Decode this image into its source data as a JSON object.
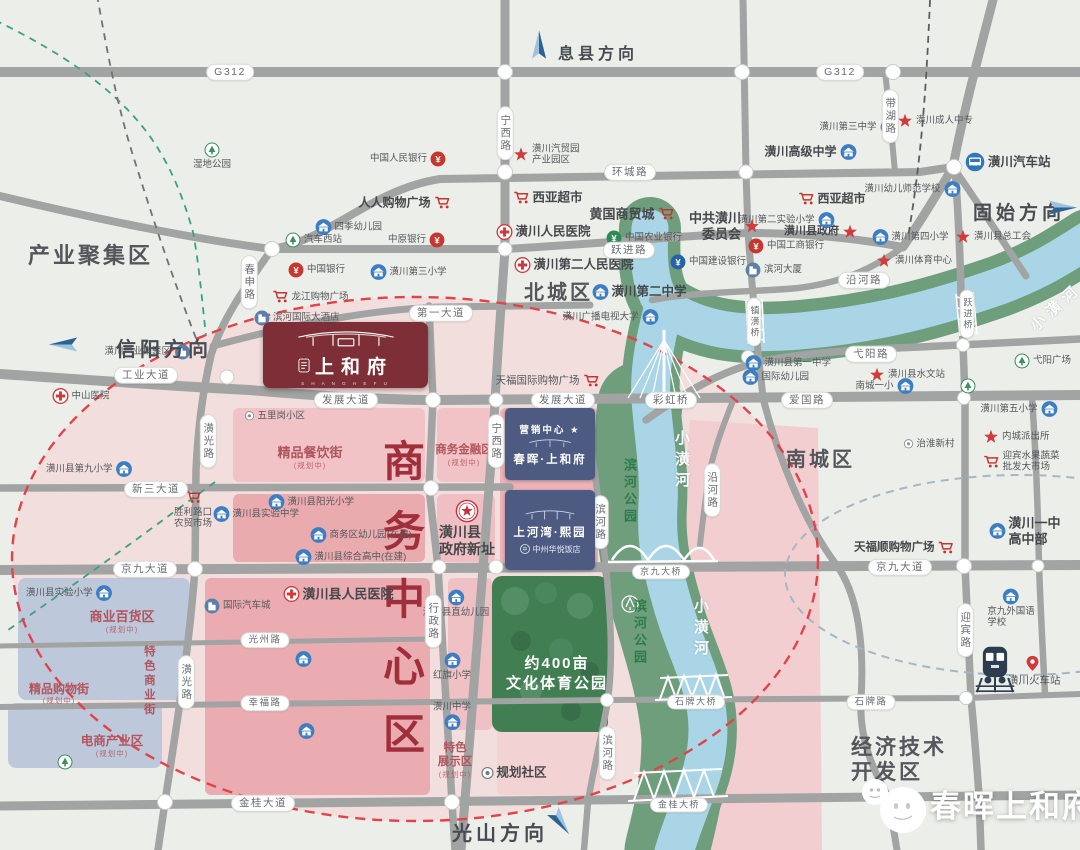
{
  "regions": [
    {
      "t": "产业聚集区",
      "x": 28,
      "y": 243,
      "s": 22
    },
    {
      "t": "北城区",
      "x": 524,
      "y": 282,
      "s": 20
    },
    {
      "t": "南城区",
      "x": 786,
      "y": 449,
      "s": 20
    },
    {
      "t": "经济技术",
      "x": 851,
      "y": 736,
      "s": 21
    },
    {
      "t": "开发区",
      "x": 851,
      "y": 761,
      "s": 21
    }
  ],
  "biz": {
    "chars": [
      "商",
      "务",
      "中",
      "心",
      "区"
    ],
    "x": 404,
    "ys": [
      462,
      532,
      600,
      667,
      735
    ]
  },
  "directions": [
    {
      "t": "息县方向",
      "x": 558,
      "y": 40,
      "s": 16,
      "rot": -90,
      "ax": 524,
      "ay": 36
    },
    {
      "t": "固始方向",
      "x": 973,
      "y": 198,
      "s": 19,
      "rot": 0,
      "ax": 1048,
      "ay": 199
    },
    {
      "t": "信阳方向",
      "x": 116,
      "y": 333,
      "s": 20,
      "rot": 180,
      "ax": 48,
      "ay": 336
    },
    {
      "t": "光山方向",
      "x": 452,
      "y": 817,
      "s": 20,
      "rot": 55,
      "ax": 546,
      "ay": 814
    }
  ],
  "pills": [
    {
      "t": "G312",
      "x": 230,
      "y": 72
    },
    {
      "t": "G312",
      "x": 840,
      "y": 72
    },
    {
      "t": "宁西路",
      "x": 505,
      "y": 133,
      "v": 1
    },
    {
      "t": "宁西路",
      "x": 496,
      "y": 441,
      "v": 1
    },
    {
      "t": "带湖路",
      "x": 890,
      "y": 116,
      "v": 1
    },
    {
      "t": "环城路",
      "x": 630,
      "y": 172
    },
    {
      "t": "春申路",
      "x": 249,
      "y": 282,
      "v": 1
    },
    {
      "t": "跃进路",
      "x": 629,
      "y": 250
    },
    {
      "t": "第一大道",
      "x": 441,
      "y": 313
    },
    {
      "t": "工业大道",
      "x": 146,
      "y": 375
    },
    {
      "t": "发展大道",
      "x": 346,
      "y": 400
    },
    {
      "t": "发展大道",
      "x": 563,
      "y": 400
    },
    {
      "t": "彩虹桥",
      "x": 671,
      "y": 400
    },
    {
      "t": "爱国路",
      "x": 807,
      "y": 400
    },
    {
      "t": "沿河路",
      "x": 864,
      "y": 280
    },
    {
      "t": "弋阳路",
      "x": 871,
      "y": 354
    },
    {
      "t": "沿河路",
      "x": 712,
      "y": 490,
      "v": 1
    },
    {
      "t": "潢光路",
      "x": 208,
      "y": 441,
      "v": 1
    },
    {
      "t": "潢光路",
      "x": 186,
      "y": 682,
      "v": 1
    },
    {
      "t": "新三大道",
      "x": 156,
      "y": 489
    },
    {
      "t": "行政路",
      "x": 433,
      "y": 621,
      "v": 1
    },
    {
      "t": "滨河路",
      "x": 600,
      "y": 522,
      "v": 1
    },
    {
      "t": "滨河路",
      "x": 607,
      "y": 753,
      "v": 1
    },
    {
      "t": "京九大道",
      "x": 145,
      "y": 569
    },
    {
      "t": "京九大道",
      "x": 900,
      "y": 567
    },
    {
      "t": "京九大桥",
      "x": 661,
      "y": 572,
      "s": 9
    },
    {
      "t": "镇潢桥",
      "x": 754,
      "y": 322,
      "v": 1,
      "s": 9
    },
    {
      "t": "跃进桥",
      "x": 967,
      "y": 314,
      "v": 1,
      "s": 9
    },
    {
      "t": "光州路",
      "x": 265,
      "y": 640,
      "s": 9.5
    },
    {
      "t": "幸福路",
      "x": 265,
      "y": 703,
      "s": 9.5
    },
    {
      "t": "石牌路",
      "x": 871,
      "y": 702,
      "s": 9.5
    },
    {
      "t": "石牌大桥",
      "x": 696,
      "y": 702,
      "s": 9
    },
    {
      "t": "金桂大桥",
      "x": 679,
      "y": 805,
      "s": 9
    },
    {
      "t": "金桂大道",
      "x": 263,
      "y": 803
    },
    {
      "t": "迎宾路",
      "x": 965,
      "y": 630,
      "v": 1
    }
  ],
  "zone_labels": [
    {
      "t": "精品餐饮街",
      "sub": "(规划中)",
      "x": 310,
      "y": 445,
      "s": 13
    },
    {
      "t": "商务金融区",
      "sub": "(规划中)",
      "x": 464,
      "y": 444,
      "s": 11.5
    },
    {
      "t": "商业百货区",
      "sub": "(规划中)",
      "x": 122,
      "y": 609,
      "s": 13
    },
    {
      "t": "精品购物街",
      "sub": "(规划中)",
      "x": 59,
      "y": 682,
      "s": 12
    },
    {
      "t": "特色商业街",
      "x": 148,
      "y": 645,
      "v": 1,
      "s": 11.5
    },
    {
      "t": "电商产业区",
      "sub": "(规划中)",
      "x": 112,
      "y": 734,
      "s": 12.5
    },
    {
      "t": "特色",
      "x": 455,
      "y": 742,
      "s": 11.5
    },
    {
      "t": "展示区",
      "sub": "(规划中)",
      "x": 455,
      "y": 756,
      "s": 11.5
    }
  ],
  "river_labels": [
    {
      "t": "小潢河",
      "x": 671,
      "y": 430,
      "cls": "white",
      "s": 15
    },
    {
      "t": "小潢河",
      "x": 690,
      "y": 598,
      "cls": "white",
      "s": 15
    },
    {
      "t": "小潢河",
      "x": 1024,
      "y": 296,
      "cls": "white",
      "s": 15,
      "rot": -42
    },
    {
      "t": "滨河公园",
      "x": 620,
      "y": 458,
      "cls": "green",
      "s": 13
    },
    {
      "t": "滨河公园",
      "x": 630,
      "y": 599,
      "cls": "green",
      "s": 13
    }
  ],
  "park_label": {
    "l1": "约400亩",
    "l2": "文化体育公园",
    "x": 557,
    "y": 652
  },
  "project": {
    "name": "上和府",
    "en": "S H A N G  H E  F U"
  },
  "mk1": {
    "tag": "营销中心 ★",
    "name": "春晖·上和府"
  },
  "mk2": {
    "name": "上河湾·熙园",
    "hotel": "中州华悦饭店"
  },
  "watermark": {
    "t": "春晖上和府"
  },
  "pois": [
    {
      "ic": "school",
      "t": "潢川高级中学",
      "x": 848,
      "y": 152,
      "side": "l",
      "s": 12,
      "b": 1
    },
    {
      "ic": "school",
      "t": "潢川第三中学",
      "x": 888,
      "y": 127,
      "side": "l"
    },
    {
      "ic": "star",
      "t": "潢川成人中专",
      "x": 905,
      "y": 121
    },
    {
      "ic": "school",
      "t": "潢川幼儿师范学校",
      "x": 952,
      "y": 189,
      "side": "l"
    },
    {
      "ic": "school",
      "t": "潢川第四小学",
      "x": 880,
      "y": 237
    },
    {
      "ic": "star",
      "t": "潢川县总工会",
      "x": 963,
      "y": 237
    },
    {
      "ic": "star",
      "t": "潢川县政府",
      "x": 850,
      "y": 232,
      "side": "l",
      "s": 11,
      "b": 1
    },
    {
      "ic": "school",
      "t": "潢川第二实验小学",
      "x": 826,
      "y": 220,
      "side": "l"
    },
    {
      "ic": "star",
      "lines": [
        "中共潢川",
        "委员会"
      ],
      "t": "中共潢川委员会",
      "x": 752,
      "y": 226,
      "side": "l",
      "s": 13,
      "b": 1
    },
    {
      "ic": "cart",
      "t": "黄国商贸城",
      "x": 666,
      "y": 214,
      "side": "l",
      "s": 13,
      "b": 1
    },
    {
      "ic": "cart",
      "t": "西亚超市",
      "x": 521,
      "y": 198,
      "s": 12.5,
      "b": 1
    },
    {
      "ic": "cart",
      "t": "西亚超市",
      "x": 806,
      "y": 199,
      "s": 12,
      "b": 1
    },
    {
      "ic": "hosp",
      "t": "潢川人民医院",
      "x": 504,
      "y": 232,
      "s": 12.5,
      "b": 1
    },
    {
      "ic": "hosp",
      "t": "潢川第二人民医院",
      "x": 522,
      "y": 265,
      "s": 12.5,
      "b": 1
    },
    {
      "ic": "school",
      "t": "潢川第二中学",
      "x": 600,
      "y": 292,
      "s": 12.5,
      "b": 1
    },
    {
      "ic": "bankG",
      "t": "中国农业银行",
      "x": 614,
      "y": 238
    },
    {
      "ic": "bankB",
      "t": "中国建设银行",
      "x": 678,
      "y": 262
    },
    {
      "ic": "bankR",
      "t": "中国工商银行",
      "x": 756,
      "y": 246
    },
    {
      "ic": "bldg",
      "t": "滨河大厦",
      "x": 753,
      "y": 270
    },
    {
      "ic": "school",
      "t": "潢川广播电视大学",
      "x": 650,
      "y": 317,
      "side": "l"
    },
    {
      "ic": "cart",
      "t": "人人购物广场",
      "x": 442,
      "y": 203,
      "side": "l",
      "s": 12,
      "b": 1
    },
    {
      "ic": "school",
      "t": "四季幼儿园",
      "x": 323,
      "y": 227
    },
    {
      "ic": "tree",
      "t": "汽车西站",
      "x": 293,
      "y": 240
    },
    {
      "ic": "bankR",
      "t": "中国银行",
      "x": 296,
      "y": 270
    },
    {
      "ic": "cart",
      "t": "龙江购物广场",
      "x": 280,
      "y": 297
    },
    {
      "ic": "bldg",
      "t": "滨河国际大酒店",
      "x": 262,
      "y": 318
    },
    {
      "ic": "school",
      "t": "潢川第三小学",
      "x": 378,
      "y": 272
    },
    {
      "ic": "bankR",
      "t": "中原银行",
      "x": 437,
      "y": 240,
      "side": "l"
    },
    {
      "ic": "tree",
      "t": "湿地公园",
      "x": 212,
      "y": 150,
      "side": "b"
    },
    {
      "ic": "bldg",
      "t": "潢川产业集聚区",
      "x": 182,
      "y": 352,
      "side": "l"
    },
    {
      "ic": "hosp",
      "t": "中山医院",
      "x": 60,
      "y": 396
    },
    {
      "ic": "school",
      "t": "潢川县第九小学",
      "x": 124,
      "y": 469,
      "side": "l"
    },
    {
      "ic": "cart",
      "lines": [
        "胜利路口",
        "农贸市场"
      ],
      "t": "胜利路口农贸市场",
      "x": 193,
      "y": 497,
      "side": "b"
    },
    {
      "ic": "starc",
      "lines": [
        "潢川县",
        "政府新址"
      ],
      "t": "潢川县政府新址",
      "x": 467,
      "y": 511,
      "side": "b",
      "s": 14,
      "b": 1
    },
    {
      "ic": "hosp",
      "t": "潢川县人民医院",
      "x": 291,
      "y": 594,
      "s": 13,
      "b": 1
    },
    {
      "ic": "bldg",
      "t": "国际汽车城",
      "x": 212,
      "y": 606
    },
    {
      "ic": "school",
      "t": "潢川县阳光小学",
      "x": 276,
      "y": 502
    },
    {
      "ic": "school",
      "t": "潢川县实验中学",
      "x": 221,
      "y": 514
    },
    {
      "ic": "school",
      "t": "商务区幼儿园(在建)",
      "x": 318,
      "y": 535
    },
    {
      "ic": "school",
      "t": "潢川县综合高中(在建)",
      "x": 303,
      "y": 557
    },
    {
      "ic": "school",
      "t": "",
      "x": 303,
      "y": 659
    },
    {
      "ic": "school",
      "t": "",
      "x": 306,
      "y": 731
    },
    {
      "ic": "school",
      "t": "潢川县实验小学",
      "x": 104,
      "y": 593,
      "side": "l"
    },
    {
      "ic": "gov",
      "t": "规划社区",
      "x": 487,
      "y": 773,
      "s": 12.5,
      "b": 1
    },
    {
      "ic": "school",
      "t": "潢川县直幼儿园",
      "x": 456,
      "y": 597,
      "side": "b"
    },
    {
      "ic": "school",
      "t": "红旗小学",
      "x": 452,
      "y": 660,
      "side": "b"
    },
    {
      "ic": "school",
      "t": "潢川中学",
      "x": 452,
      "y": 722,
      "side": "a"
    },
    {
      "ic": "cart",
      "t": "天福国际购物广场",
      "x": 591,
      "y": 381,
      "side": "l",
      "s": 10.5
    },
    {
      "ic": "cart",
      "t": "天福顺购物广场",
      "x": 946,
      "y": 548,
      "side": "l",
      "s": 11.5,
      "b": 1
    },
    {
      "ic": "train",
      "t": "",
      "x": 995,
      "y": 669
    },
    {
      "ic": "pin",
      "t": "",
      "x": 1032,
      "y": 663
    },
    {
      "ic": "none",
      "t": "潢川火车站",
      "x": 1008,
      "y": 681,
      "s": 10.5
    },
    {
      "ic": "school",
      "lines": [
        "京九外国语",
        "学校"
      ],
      "t": "京九外国语学校",
      "x": 1011,
      "y": 596,
      "side": "b"
    },
    {
      "ic": "school",
      "lines": [
        "潢川一中",
        "高中部"
      ],
      "t": "潢川一中高中部",
      "x": 997,
      "y": 531,
      "s": 13,
      "b": 1
    },
    {
      "ic": "school",
      "t": "潢川第五小学",
      "x": 1049,
      "y": 409,
      "side": "l"
    },
    {
      "ic": "star",
      "t": "内城派出所",
      "x": 991,
      "y": 437
    },
    {
      "ic": "cart",
      "lines": [
        "迎宾水果蔬菜",
        "批发大市场"
      ],
      "t": "迎宾水果蔬菜批发大市场",
      "x": 991,
      "y": 462
    },
    {
      "ic": "dot",
      "t": "治淮新村",
      "x": 908,
      "y": 444
    },
    {
      "ic": "tree",
      "t": "弋阳广场",
      "x": 1022,
      "y": 361
    },
    {
      "ic": "school",
      "t": "潢川县第一中学",
      "x": 753,
      "y": 363
    },
    {
      "ic": "school",
      "t": "国际幼儿园",
      "x": 750,
      "y": 377
    },
    {
      "ic": "star",
      "t": "潢川县水文站",
      "x": 877,
      "y": 375
    },
    {
      "ic": "school",
      "t": "南城一小",
      "x": 905,
      "y": 386,
      "side": "l"
    },
    {
      "ic": "tree",
      "t": "",
      "x": 968,
      "y": 386
    },
    {
      "ic": "star",
      "t": "潢川体育中心",
      "x": 884,
      "y": 261
    },
    {
      "ic": "bankR",
      "t": "中国人民银行",
      "x": 438,
      "y": 159,
      "side": "l"
    },
    {
      "ic": "star",
      "lines": [
        "潢川汽贸园",
        "产业园区"
      ],
      "t": "潢川汽贸园产业园区",
      "x": 521,
      "y": 155
    },
    {
      "ic": "bus",
      "t": "潢川汽车站",
      "x": 975,
      "y": 162,
      "s": 12.5,
      "b": 1
    },
    {
      "ic": "dot",
      "t": "五里岗小区",
      "x": 249,
      "y": 416
    },
    {
      "ic": "tree",
      "t": "",
      "x": 65,
      "y": 762
    }
  ]
}
